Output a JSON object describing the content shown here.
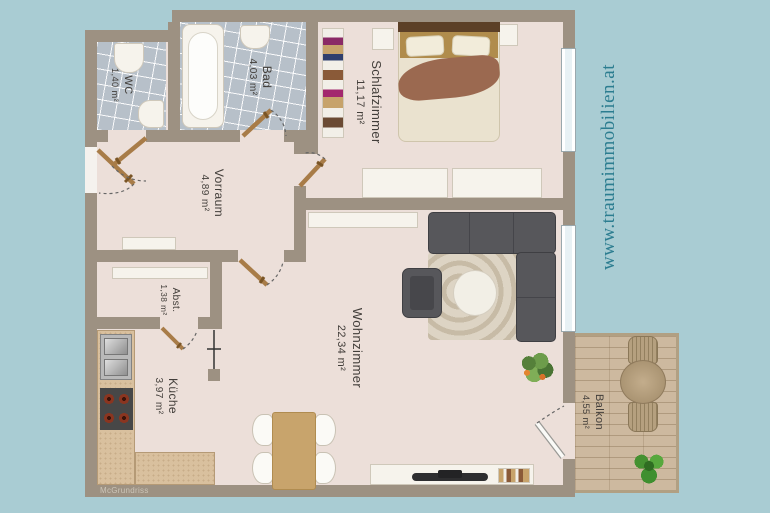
{
  "watermark": {
    "text": "www.traumimmobilien.at",
    "color": "#2c7d90"
  },
  "credit": {
    "text": "McGrundriss"
  },
  "rooms": [
    {
      "id": "wc",
      "name": "WC",
      "area": "1,40 m²"
    },
    {
      "id": "bad",
      "name": "Bad",
      "area": "4,03 m²"
    },
    {
      "id": "schlafzimmer",
      "name": "Schlafzimmer",
      "area": "11,17 m²"
    },
    {
      "id": "vorraum",
      "name": "Vorraum",
      "area": "4,89 m²"
    },
    {
      "id": "abstellraum",
      "name": "Abst.",
      "area": "1,38 m²"
    },
    {
      "id": "kueche",
      "name": "Küche",
      "area": "3,97 m²"
    },
    {
      "id": "wohnzimmer",
      "name": "Wohnzimmer",
      "area": "22,34 m²"
    },
    {
      "id": "balkon",
      "name": "Balkon",
      "area": "4,55 m²"
    }
  ],
  "colors": {
    "background": "#a9ccd3",
    "wall": "#9d9182",
    "floor": "#ecdfd9",
    "tile": "#b7c0c9",
    "deck": "#cdb99f",
    "counter": "#d9c09e",
    "sofa": "#57575b",
    "door_leaf": "#a87c48",
    "watermark_teal": "#2c7d90"
  }
}
